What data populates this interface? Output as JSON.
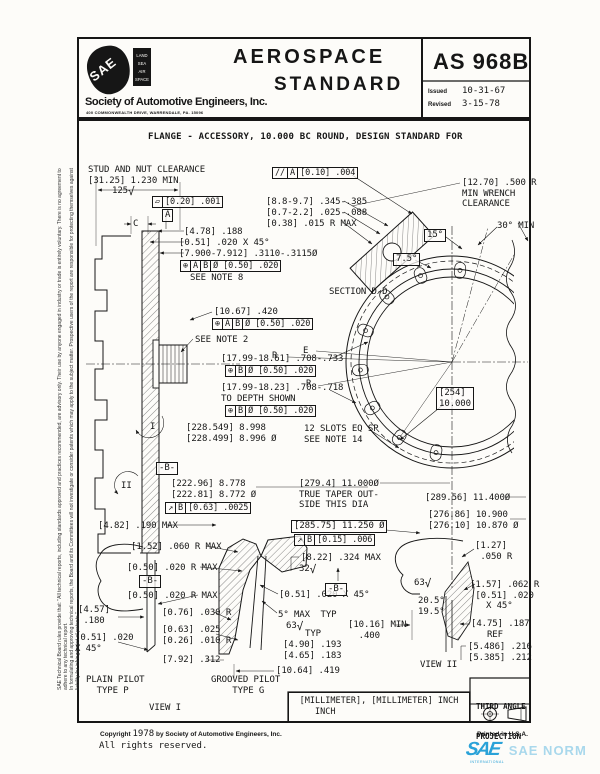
{
  "header": {
    "logo_text": "SAE",
    "tag_lines": [
      "LAND",
      "SEA",
      "AIR",
      "SPACE"
    ],
    "org_name": "Society of Automotive Engineers, Inc.",
    "org_address": "400 COMMONWEALTH DRIVE, WARRENDALE, PA. 15096",
    "doc_type_line1": "AEROSPACE",
    "doc_type_line2": "STANDARD",
    "doc_number": "AS 968B",
    "issued_label": "Issued",
    "issued_value": "10-31-67",
    "revised_label": "Revised",
    "revised_value": "3-15-78"
  },
  "title": "FLANGE - ACCESSORY, 10.000 BC ROUND, DESIGN STANDARD FOR",
  "sidebar": {
    "line1": "SAE Technical Board rules provide that: \"All technical reports, including standards approved and practices recommended, are advisory only. Their use by anyone engaged in industry or trade is entirely voluntary. There is no agreement to adhere to any technical report.",
    "line2": "In formulating and approving technical reports, the Board and its Committees will not investigate or consider patents which may apply to the subject matter. Prospective users of the report are responsible for protecting themselves against liability for infringement of patents.\""
  },
  "units_box": {
    "line1": "[MILLIMETER], [MILLIMETER] INCH",
    "line2": "INCH"
  },
  "projection_box": {
    "line1": "THIRD ANGLE",
    "line2": "PROJECTION"
  },
  "footer": {
    "copyright_pre": "Copyright",
    "copyright_year": "1978",
    "copyright_post": " by Society of Automotive Engineers, Inc.",
    "rights": "All rights reserved.",
    "printed": "Printed in U.S.A.",
    "watermark_logo": "SAE",
    "watermark_text": "SAE NORM",
    "watermark_sub": "INTERNATIONAL"
  },
  "colors": {
    "ink": "#161616",
    "accent_blue": "#2aa2d8",
    "accent_blue_light": "#a9d8ec"
  },
  "annotations": [
    {
      "t": "text",
      "x": 88,
      "y": 165,
      "s": "STUD AND NUT CLEARANCE"
    },
    {
      "t": "text",
      "x": 88,
      "y": 176,
      "s": "[31.25] 1.230 MIN"
    },
    {
      "t": "fin",
      "x": 112,
      "y": 186,
      "s": "125"
    },
    {
      "t": "fcf",
      "x": 152,
      "y": 196,
      "c": [
        "▱",
        "[0.20] .001"
      ]
    },
    {
      "t": "bx",
      "x": 162,
      "y": 209,
      "s": "A"
    },
    {
      "t": "text",
      "x": 133,
      "y": 219,
      "s": "C"
    },
    {
      "t": "text",
      "x": 184,
      "y": 227,
      "s": "[4.78] .188"
    },
    {
      "t": "text",
      "x": 179,
      "y": 238,
      "s": "[0.51] .020 X 45°"
    },
    {
      "t": "text",
      "x": 179,
      "y": 249,
      "s": "[7.900-7.912] .3110-.3115Ø"
    },
    {
      "t": "fcf",
      "x": 180,
      "y": 260,
      "c": [
        "⊕",
        "A",
        "B",
        "Ø [0.50] .020"
      ]
    },
    {
      "t": "text",
      "x": 190,
      "y": 273,
      "s": "SEE NOTE 8"
    },
    {
      "t": "fcf",
      "x": 272,
      "y": 167,
      "c": [
        "//",
        "A",
        "[0.10] .004"
      ]
    },
    {
      "t": "text",
      "x": 266,
      "y": 197,
      "s": "[8.8-9.7] .345-.385"
    },
    {
      "t": "text",
      "x": 266,
      "y": 208,
      "s": "[0.7-2.2] .025-.088"
    },
    {
      "t": "text",
      "x": 266,
      "y": 219,
      "s": "[0.38] .015 R MAX"
    },
    {
      "t": "text",
      "x": 462,
      "y": 178,
      "s": "[12.70] .500 R\nMIN WRENCH\nCLEARANCE"
    },
    {
      "t": "text",
      "x": 497,
      "y": 221,
      "s": "30° MIN"
    },
    {
      "t": "bx",
      "x": 424,
      "y": 229,
      "s": "15°"
    },
    {
      "t": "bx",
      "x": 393,
      "y": 253,
      "s": "7.5°"
    },
    {
      "t": "text",
      "x": 329,
      "y": 287,
      "s": "SECTION D-D"
    },
    {
      "t": "text",
      "x": 214,
      "y": 307,
      "s": "[10.67] .420"
    },
    {
      "t": "fcf",
      "x": 212,
      "y": 318,
      "c": [
        "⊕",
        "A",
        "B",
        "Ø [0.50] .020"
      ]
    },
    {
      "t": "text",
      "x": 195,
      "y": 335,
      "s": "SEE NOTE 2"
    },
    {
      "t": "text",
      "x": 221,
      "y": 354,
      "s": "[17.99-18.61] .708-.733"
    },
    {
      "t": "fcf",
      "x": 225,
      "y": 365,
      "c": [
        "⊕",
        "B",
        "Ø [0.50] .020"
      ]
    },
    {
      "t": "text",
      "x": 221,
      "y": 383,
      "s": "[17.99-18.23] .708-.718"
    },
    {
      "t": "text",
      "x": 221,
      "y": 394,
      "s": "TO DEPTH SHOWN"
    },
    {
      "t": "fcf",
      "x": 225,
      "y": 405,
      "c": [
        "⊕",
        "B",
        "Ø [0.50] .020"
      ]
    },
    {
      "t": "text",
      "x": 186,
      "y": 423,
      "s": "[228.549] 8.998\n[228.499] 8.996 Ø"
    },
    {
      "t": "text",
      "x": 304,
      "y": 424,
      "s": "12 SLOTS EQ SP\nSEE NOTE 14"
    },
    {
      "t": "text",
      "x": 303,
      "y": 346,
      "s": "E"
    },
    {
      "t": "text",
      "x": 272,
      "y": 351,
      "s": "R"
    },
    {
      "t": "text",
      "x": 306,
      "y": 379,
      "s": "R"
    },
    {
      "t": "bx",
      "x": 436,
      "y": 387,
      "s": "[254]\n10.000"
    },
    {
      "t": "text",
      "x": 150,
      "y": 422,
      "s": "I"
    },
    {
      "t": "text",
      "x": 121,
      "y": 481,
      "s": "II"
    },
    {
      "t": "bx",
      "x": 156,
      "y": 462,
      "s": "-B-"
    },
    {
      "t": "text",
      "x": 171,
      "y": 479,
      "s": "[222.96] 8.778\n[222.81] 8.772 Ø"
    },
    {
      "t": "fcf",
      "x": 165,
      "y": 502,
      "c": [
        "↗",
        "B",
        "[0.63] .0025"
      ]
    },
    {
      "t": "text",
      "x": 299,
      "y": 479,
      "s": "[279.4] 11.000Ø\nTRUE TAPER OUT-\nSIDE THIS DIA"
    },
    {
      "t": "bx",
      "x": 291,
      "y": 520,
      "s": "[285.75] 11.250 Ø"
    },
    {
      "t": "fcf",
      "x": 294,
      "y": 534,
      "c": [
        "↗",
        "B",
        "[0.15] .006"
      ]
    },
    {
      "t": "text",
      "x": 98,
      "y": 521,
      "s": "[4.82] .190 MAX"
    },
    {
      "t": "text",
      "x": 131,
      "y": 542,
      "s": "[1.52] .060 R MAX"
    },
    {
      "t": "text",
      "x": 127,
      "y": 563,
      "s": "[0.50] .020 R MAX"
    },
    {
      "t": "bx",
      "x": 139,
      "y": 575,
      "s": "-B-"
    },
    {
      "t": "text",
      "x": 127,
      "y": 591,
      "s": "[0.50] .020 R MAX"
    },
    {
      "t": "text",
      "x": 78,
      "y": 605,
      "s": "[4.57]\n .180"
    },
    {
      "t": "text",
      "x": 75,
      "y": 633,
      "s": "[0.51] .020\nX 45°"
    },
    {
      "t": "text",
      "x": 162,
      "y": 608,
      "s": "[0.76] .030 R"
    },
    {
      "t": "text",
      "x": 162,
      "y": 625,
      "s": "[0.63] .025\n[0.26] .010 R"
    },
    {
      "t": "text",
      "x": 162,
      "y": 655,
      "s": "[7.92] .312"
    },
    {
      "t": "text",
      "x": 86,
      "y": 675,
      "s": "PLAIN PILOT\n  TYPE P"
    },
    {
      "t": "text",
      "x": 211,
      "y": 675,
      "s": "GROOVED PILOT\n    TYPE G"
    },
    {
      "t": "text",
      "x": 149,
      "y": 703,
      "s": "VIEW I"
    },
    {
      "t": "text",
      "x": 279,
      "y": 590,
      "s": "[0.51] .020 X 45°"
    },
    {
      "t": "text",
      "x": 278,
      "y": 610,
      "s": "5° MAX  TYP"
    },
    {
      "t": "fin",
      "x": 286,
      "y": 621,
      "s": "63"
    },
    {
      "t": "text",
      "x": 305,
      "y": 629,
      "s": "TYP"
    },
    {
      "t": "text",
      "x": 283,
      "y": 640,
      "s": "[4.90] .193\n[4.65] .183"
    },
    {
      "t": "text",
      "x": 276,
      "y": 666,
      "s": "[10.64] .419"
    },
    {
      "t": "text",
      "x": 348,
      "y": 620,
      "s": "[10.16] MIN\n  .400"
    },
    {
      "t": "text",
      "x": 301,
      "y": 553,
      "s": "[8.22] .324 MAX"
    },
    {
      "t": "fin",
      "x": 299,
      "y": 564,
      "s": "32"
    },
    {
      "t": "bx",
      "x": 325,
      "y": 583,
      "s": "-B-"
    },
    {
      "t": "text",
      "x": 425,
      "y": 493,
      "s": "[289.56] 11.400Ø"
    },
    {
      "t": "text",
      "x": 428,
      "y": 510,
      "s": "[276.86] 10.900\n[276.10] 10.870 Ø"
    },
    {
      "t": "text",
      "x": 475,
      "y": 541,
      "s": "[1.27]\n .050 R"
    },
    {
      "t": "fin",
      "x": 414,
      "y": 578,
      "s": "63"
    },
    {
      "t": "text",
      "x": 418,
      "y": 596,
      "s": "20.5°\n19.5°"
    },
    {
      "t": "text",
      "x": 470,
      "y": 580,
      "s": "[1.57] .062 R\n [0.51] .020\n   X 45°"
    },
    {
      "t": "text",
      "x": 471,
      "y": 619,
      "s": "[4.75] .187\n   REF"
    },
    {
      "t": "text",
      "x": 468,
      "y": 642,
      "s": "[5.486] .216\n[5.385] .212"
    },
    {
      "t": "text",
      "x": 420,
      "y": 660,
      "s": "VIEW II"
    }
  ]
}
